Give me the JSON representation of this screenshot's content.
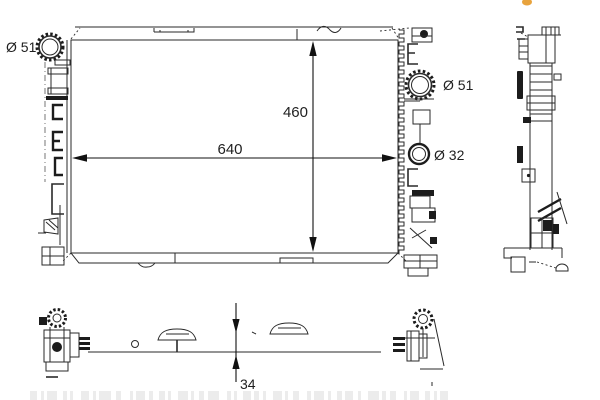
{
  "drawing": {
    "type": "radiator-technical-drawing",
    "labels": {
      "inlet_left_diameter": "Ø 51",
      "inlet_right_diameter": "Ø 51",
      "outlet_diameter": "Ø 32",
      "core_width": "640",
      "core_height": "460",
      "core_thickness": "34"
    },
    "colors": {
      "line": "#2a2a2a",
      "background": "#ffffff",
      "accent_dot": "#E8A33D",
      "barcode_bar": "#ececec"
    }
  }
}
